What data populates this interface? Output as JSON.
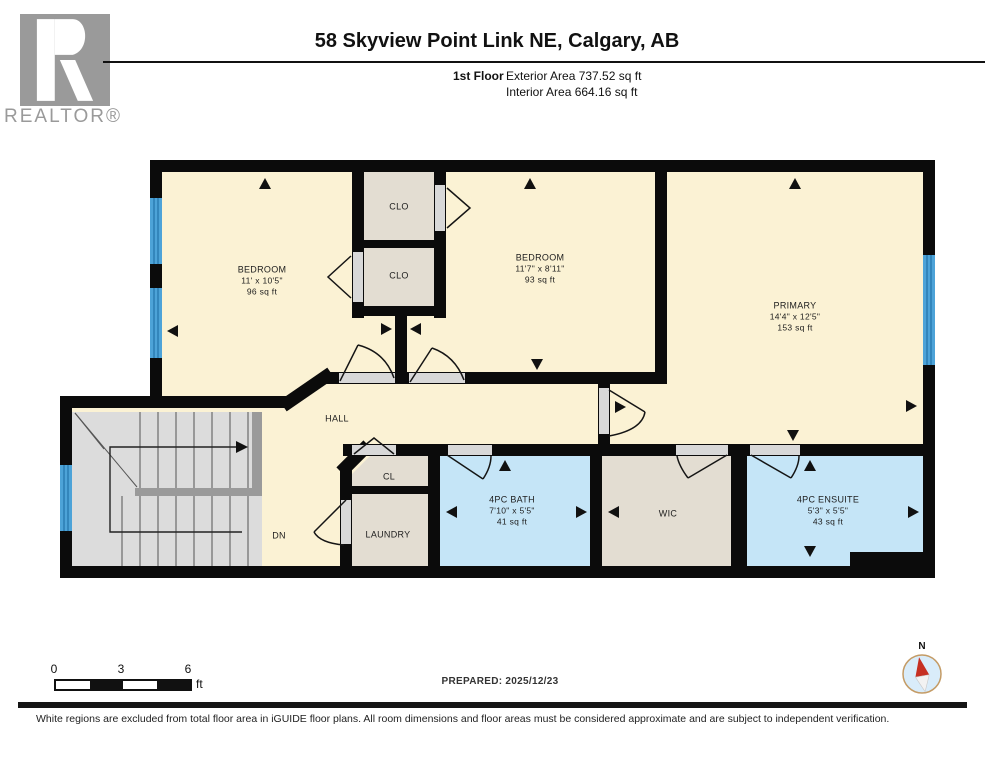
{
  "header": {
    "logo_r": "R",
    "logo_text": "REALTOR®",
    "title": "58 Skyview Point Link NE, Calgary, AB",
    "floor_label": "1st Floor",
    "exterior_area": "Exterior Area 737.52 sq ft",
    "interior_area": "Interior Area 664.16 sq ft"
  },
  "plan": {
    "rooms": [
      {
        "name": "BEDROOM",
        "dims": "11' x 10'5\"",
        "area": "96 sq ft"
      },
      {
        "name": "CLO"
      },
      {
        "name": "CLO"
      },
      {
        "name": "BEDROOM",
        "dims": "11'7\" x 8'11\"",
        "area": "93 sq ft"
      },
      {
        "name": "PRIMARY",
        "dims": "14'4\" x 12'5\"",
        "area": "153 sq ft"
      },
      {
        "name": "HALL"
      },
      {
        "name": "CL"
      },
      {
        "name": "LAUNDRY"
      },
      {
        "name": "4PC BATH",
        "dims": "7'10\" x 5'5\"",
        "area": "41 sq ft"
      },
      {
        "name": "WIC"
      },
      {
        "name": "4PC ENSUITE",
        "dims": "5'3\" x 5'5\"",
        "area": "43 sq ft"
      },
      {
        "name": "DN"
      }
    ],
    "colors": {
      "room_fill": "#FBF2D4",
      "closet_fill": "#E3DDD2",
      "bath_fill": "#C5E5F7",
      "stairs_fill": "#DCDCDC",
      "wall": "#0B0B0B",
      "window": "#4DA3D8",
      "door_gap": "#D8D8D8"
    }
  },
  "scale_bar": {
    "ticks": [
      "0",
      "3",
      "6"
    ],
    "unit": "ft"
  },
  "prepared_label": "PREPARED: 2025/12/23",
  "compass": {
    "north_label": "N"
  },
  "footer": {
    "disclaimer": "White regions are excluded from total floor area in iGUIDE floor plans. All room dimensions and floor areas must be considered approximate and are subject to independent verification."
  }
}
